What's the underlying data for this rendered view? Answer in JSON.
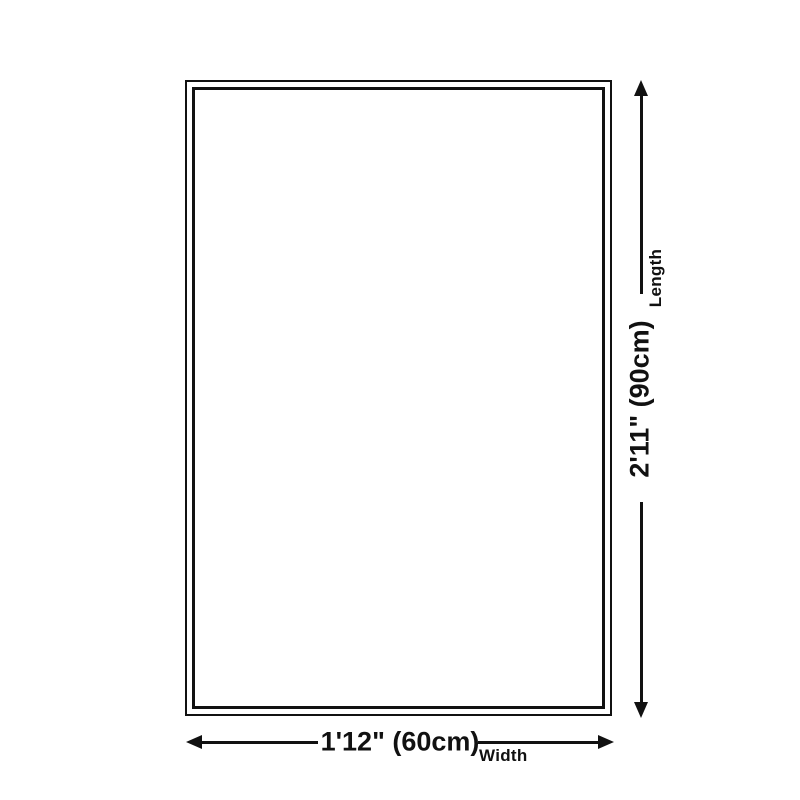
{
  "page": {
    "background_color": "#ffffff"
  },
  "diagram": {
    "type": "rug-size-dimension-diagram",
    "line_color": "#111111",
    "rug": {
      "fill_color": "#ffffff",
      "border_color": "#111111"
    },
    "length_dimension": {
      "value": "2'11\" (90cm)",
      "axis_label": "Length"
    },
    "width_dimension": {
      "value": "1'12\" (60cm)",
      "axis_label": "Width"
    },
    "icons": {
      "top": "arrow-up-icon",
      "bottom": "arrow-down-icon",
      "left": "arrow-left-icon",
      "right": "arrow-right-icon"
    }
  }
}
